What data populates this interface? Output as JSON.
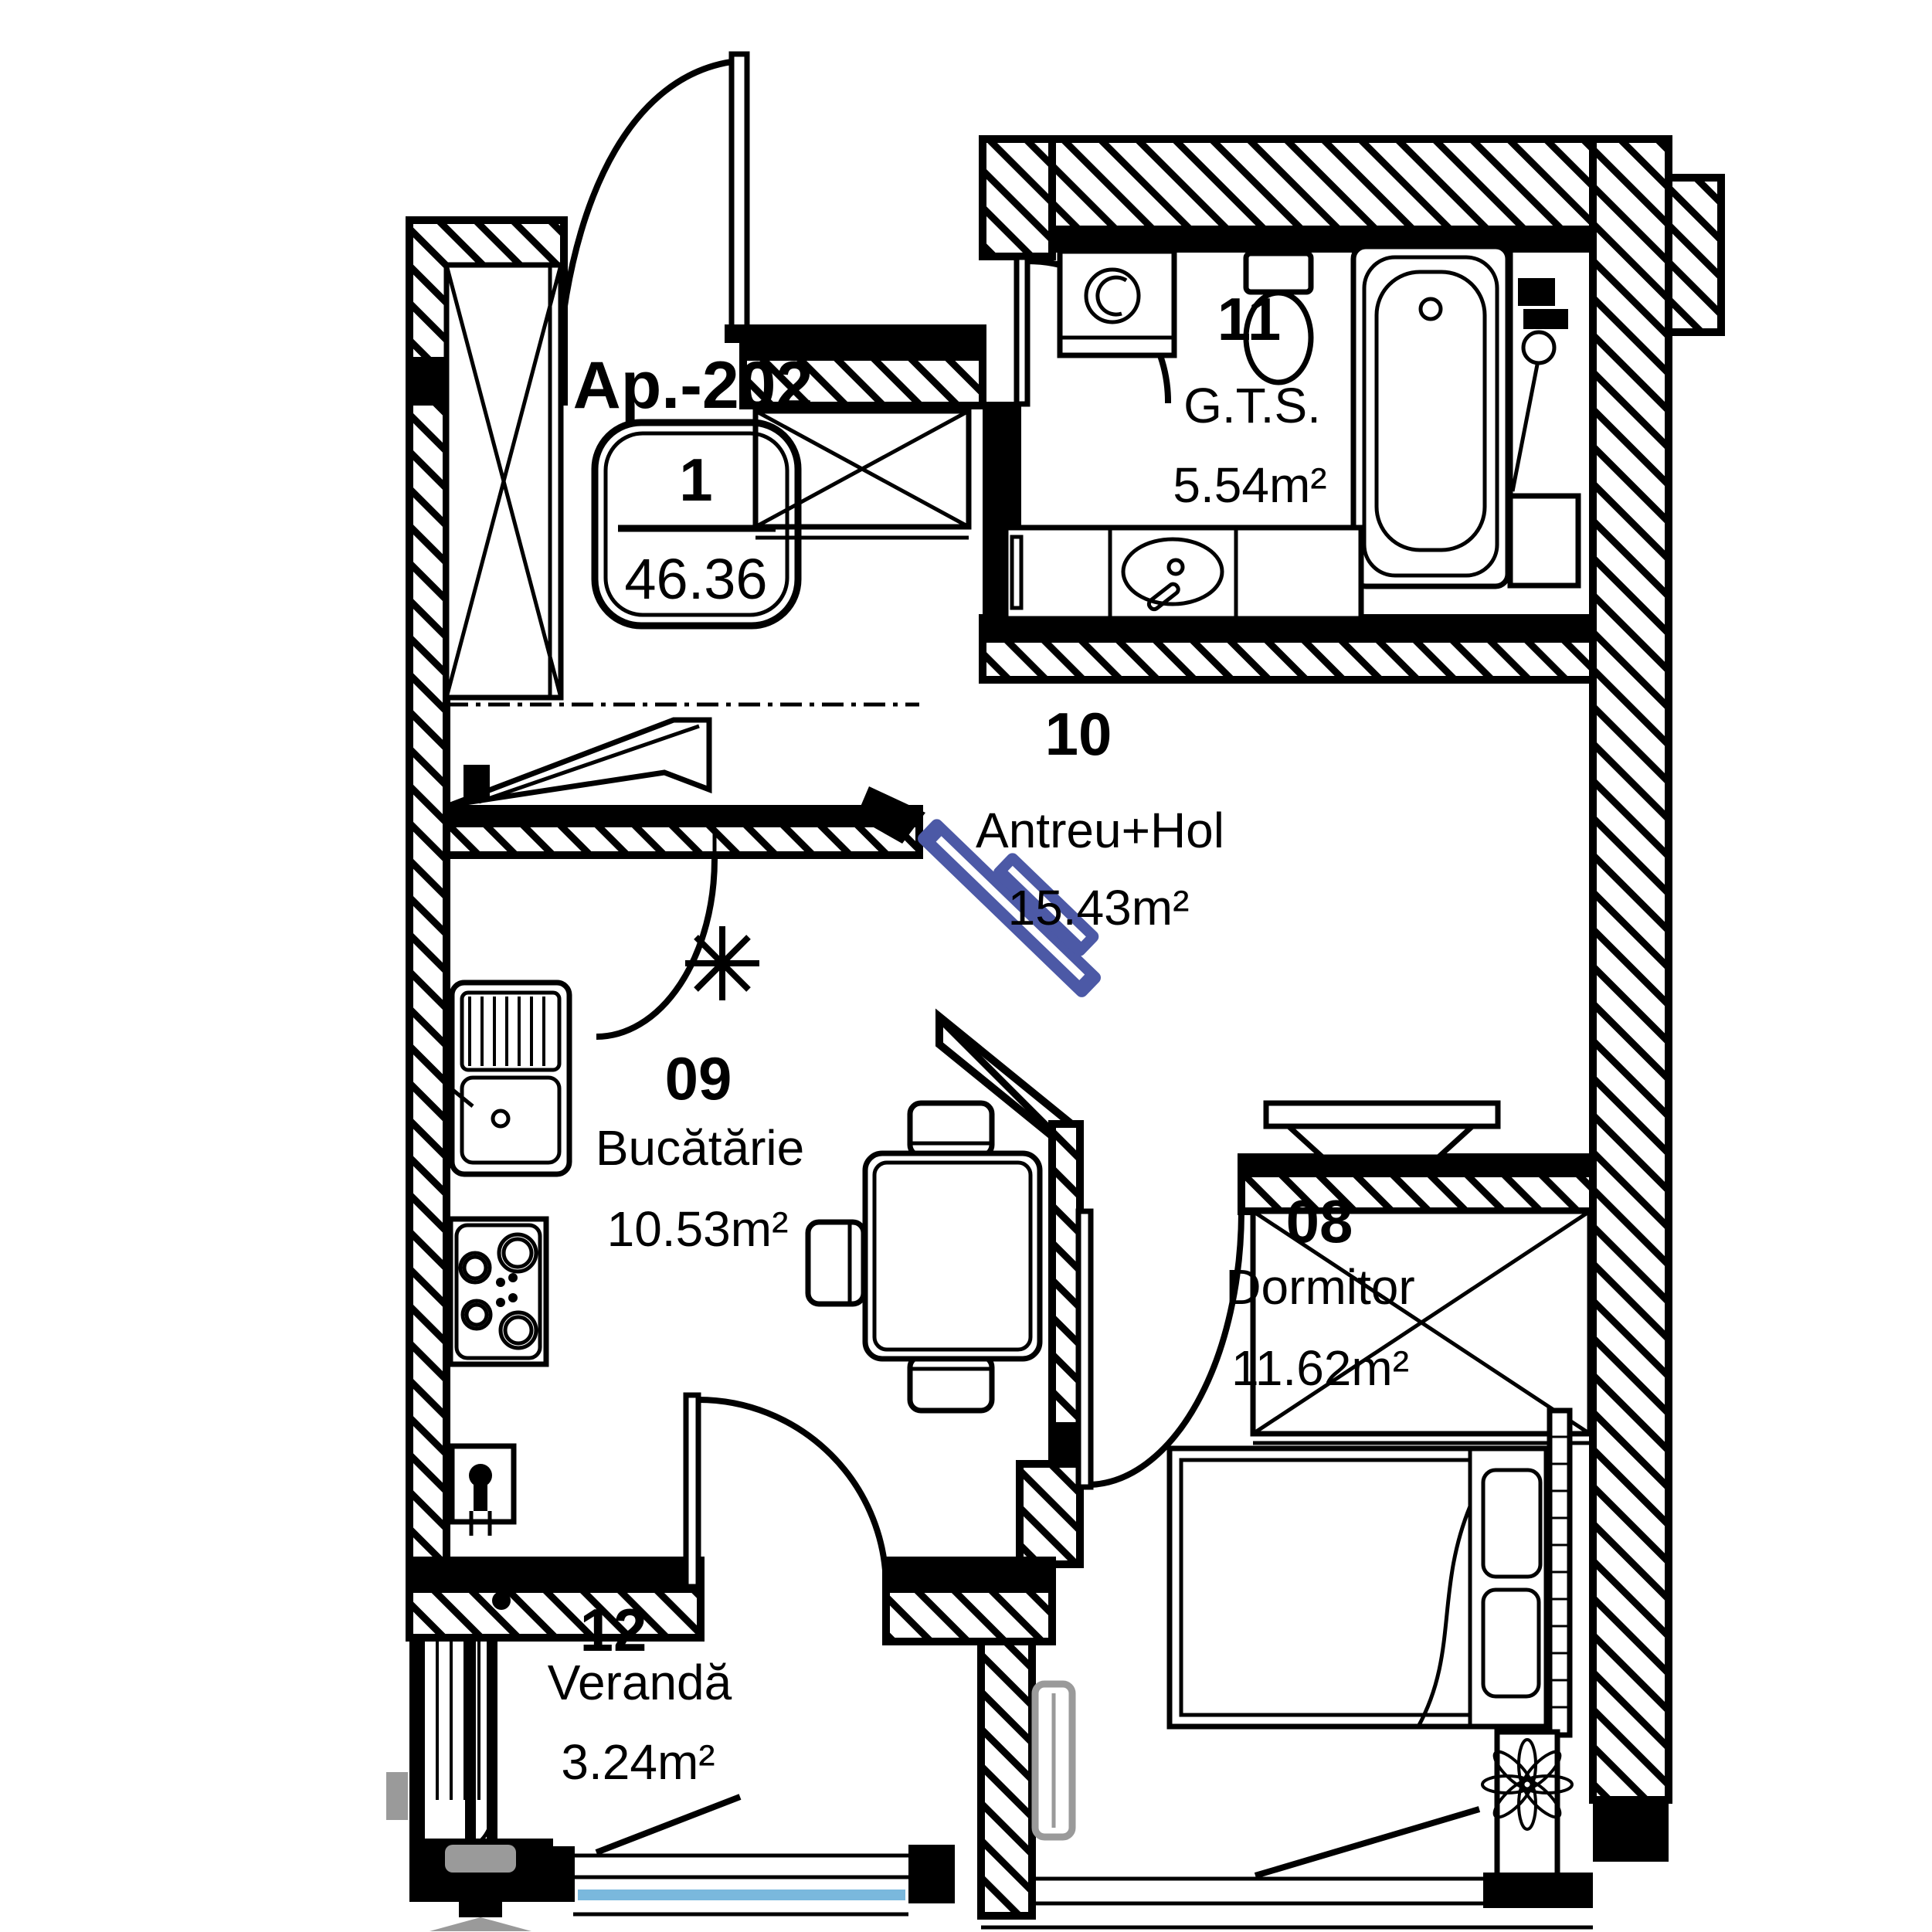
{
  "plan": {
    "apartment": {
      "label": "Ap.-202",
      "unit_rooms": "1",
      "total_area": "46.36"
    },
    "rooms": [
      {
        "number": "11",
        "name": "G.T.S.",
        "area": "5.54m²"
      },
      {
        "number": "10",
        "name": "Antreu+Hol",
        "area": "15.43m²"
      },
      {
        "number": "09",
        "name": "Bucătărie",
        "area": "10.53m²"
      },
      {
        "number": "08",
        "name": "Dormitor",
        "area": "11.62m²"
      },
      {
        "number": "12",
        "name": "Verandă",
        "area": "3.24m²"
      }
    ],
    "colors": {
      "line": "#000000",
      "door_accent": "#4c59a6",
      "window_glass": "#7ab8dd",
      "gray": "#9a9a9a"
    }
  }
}
